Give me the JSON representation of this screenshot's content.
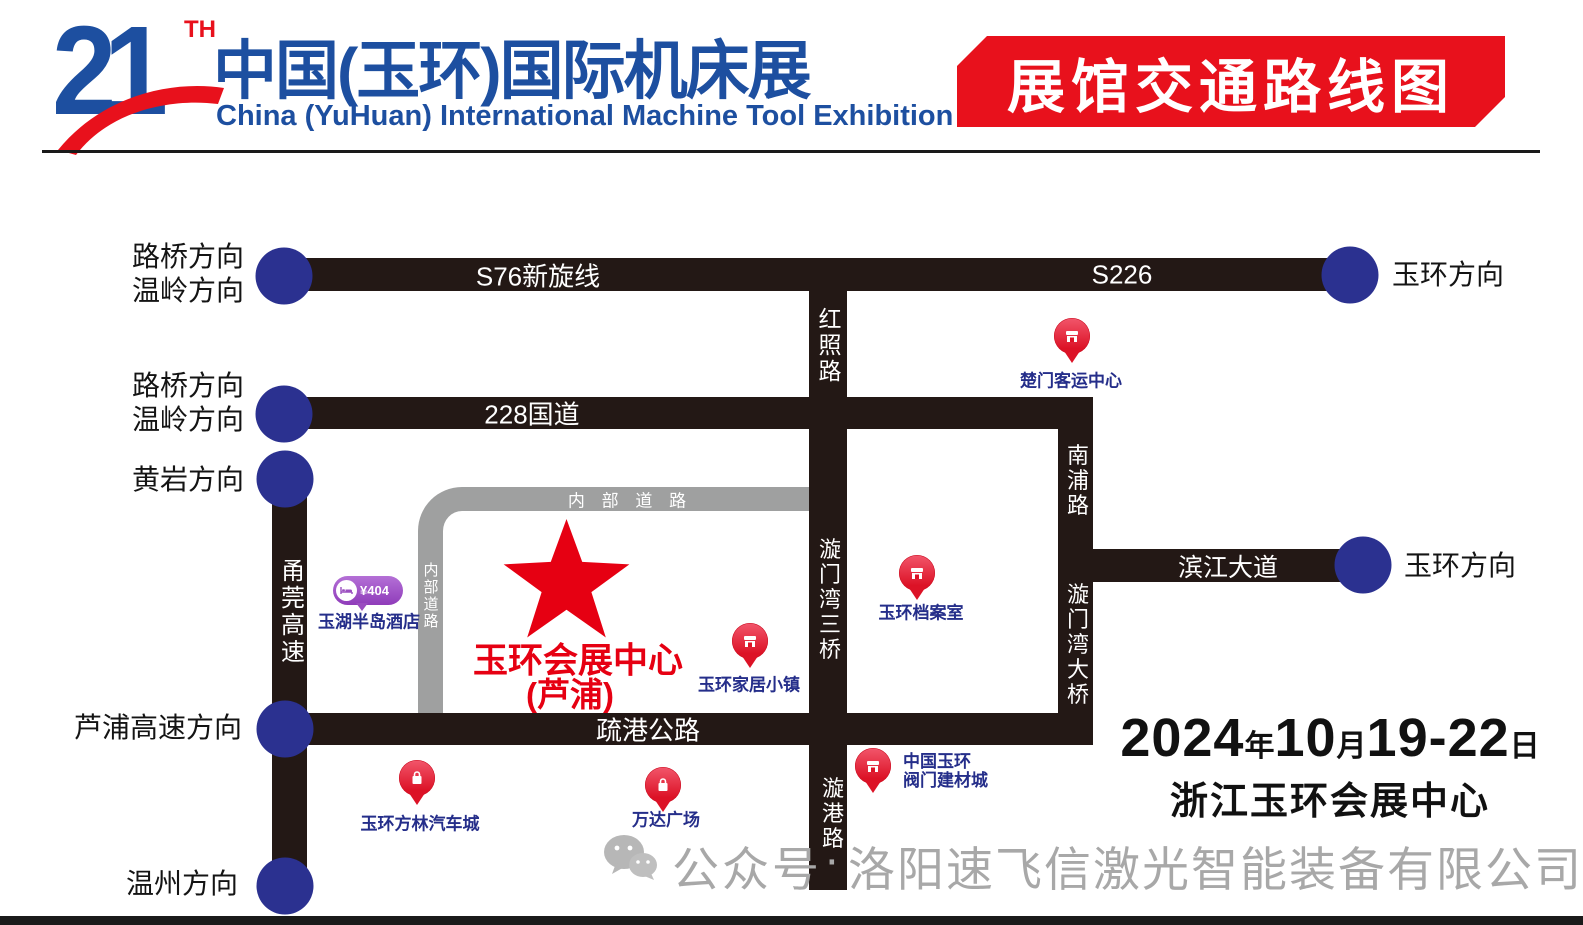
{
  "header": {
    "edition": "21",
    "edition_suffix": "TH",
    "title_cn": "中国(玉环)国际机床展",
    "title_en": "China (YuHuan) International Machine Tool Exhibition",
    "banner": "展馆交通路线图"
  },
  "roads": {
    "s76": "S76新旋线",
    "s226": "S226",
    "g228": "228国道",
    "hongzhao": "红照路",
    "xuanmenwan_3rd_bridge": "漩门湾三桥",
    "nanpu": "南浦路",
    "xuanmenwan_bridge": "漩门湾大桥",
    "binjiang": "滨江大道",
    "shugang": "疏港公路",
    "yongguan": "甬莞高速",
    "xuangang": "漩港路",
    "internal_h": "内 部 道 路",
    "internal_v": "内部道路"
  },
  "endpoints": [
    {
      "lines": [
        "路桥方向",
        "温岭方向"
      ]
    },
    {
      "lines": [
        "路桥方向",
        "温岭方向"
      ]
    },
    {
      "label": "黄岩方向"
    },
    {
      "label": "芦浦高速方向"
    },
    {
      "label": "温州方向"
    },
    {
      "label": "玉环方向"
    },
    {
      "label": "玉环方向"
    }
  ],
  "pois": [
    {
      "label": "楚门客运中心",
      "icon": "station"
    },
    {
      "label": "玉环档案室",
      "icon": "archive"
    },
    {
      "label": "玉环家居小镇",
      "icon": "home-store"
    },
    {
      "lines": [
        "中国玉环",
        "阀门建材城"
      ],
      "icon": "market"
    },
    {
      "label": "玉环方林汽车城",
      "icon": "shopping-bag"
    },
    {
      "label": "万达广场",
      "icon": "shopping-bag"
    }
  ],
  "hotel": {
    "price": "¥404",
    "name": "玉湖半岛酒店"
  },
  "venue": {
    "name": "玉环会展中心",
    "sub": "(芦浦)"
  },
  "event": {
    "date_segments": [
      "2024",
      "年",
      "10",
      "月",
      "19-22",
      "日"
    ],
    "venue_line": "浙江玉环会展中心"
  },
  "watermark": {
    "prefix": "公众号",
    "separator": "·",
    "company": "洛阳速飞信激光智能装备有限公司"
  },
  "colors": {
    "brand_blue": "#1d4fa0",
    "brand_red": "#e8111c",
    "road_black": "#231815",
    "node_blue": "#2b3190",
    "internal_road_gray": "#9fa0a0",
    "poi_label_blue": "#252e8a",
    "venue_red": "#e60012",
    "hotel_purple": "#9b4fc0",
    "watermark_gray": "#a8a8a8"
  }
}
